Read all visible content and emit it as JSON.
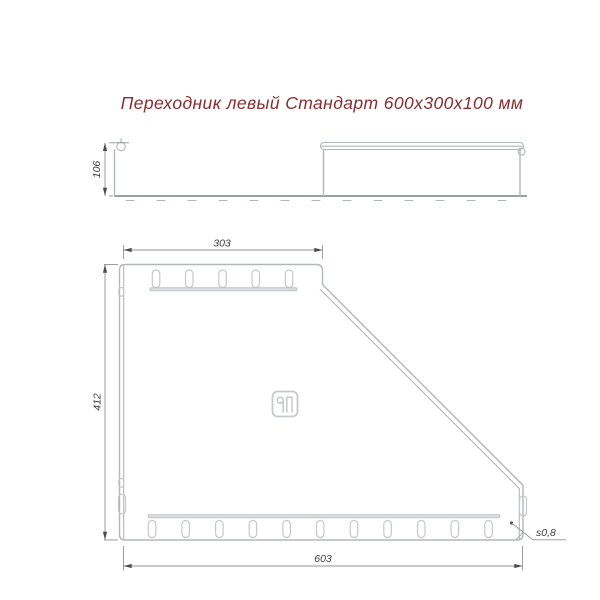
{
  "title": {
    "text": "Переходник левый Стандарт 600х300х100 мм"
  },
  "dimensions": {
    "height": "106",
    "top_width": "303",
    "length": "412",
    "bottom_width": "603",
    "thickness": "s0,8"
  },
  "logo": {
    "icon": "brand-logo-icon"
  },
  "colors": {
    "background": "#ffffff",
    "outline": "#b2b7b9",
    "perforation": "#c5c8ca",
    "dimension_line": "#8f9496",
    "dimension_text": "#3c3c3c",
    "title": "#8a2d30"
  }
}
